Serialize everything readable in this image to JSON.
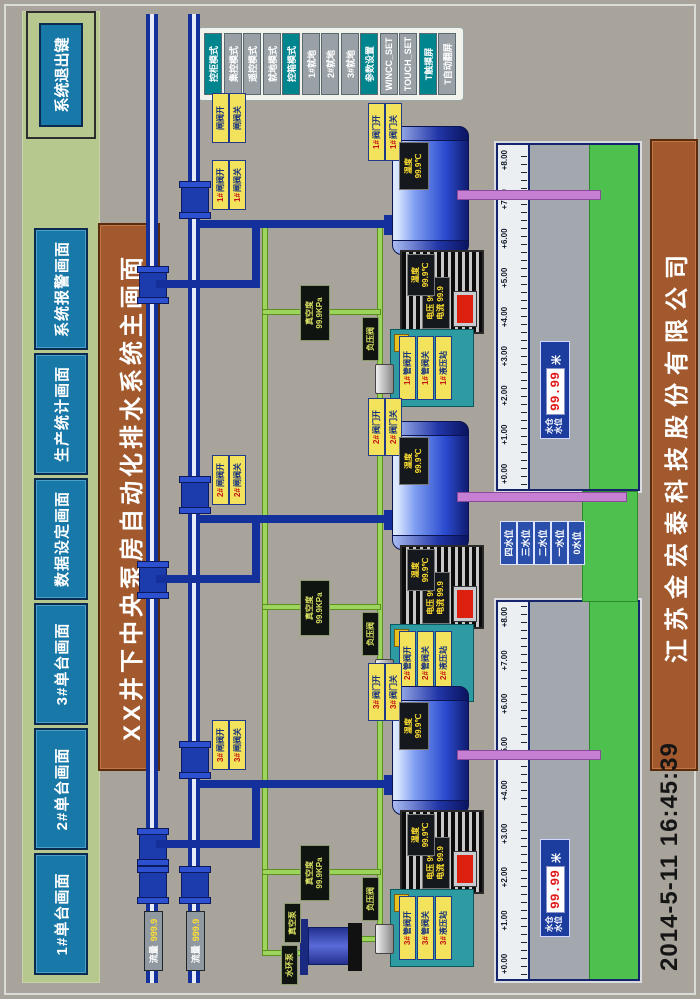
{
  "title": "XX井下中央泵房自动化排水系统主画面",
  "footer": {
    "company": "江苏金宏泰科技股份有限公司",
    "timestamp": "2014-5-11  16:45:39"
  },
  "header": {
    "nav_buttons": [
      {
        "label": "1#单台画面"
      },
      {
        "label": "2#单台画面"
      },
      {
        "label": "3#单台画面"
      },
      {
        "label": "数据设定画面"
      },
      {
        "label": "生产统计画面"
      },
      {
        "label": "系统报警画面"
      }
    ],
    "exit_button": "系统退出键"
  },
  "mode_panel": {
    "buttons": [
      {
        "label": "控柜模式",
        "style": "teal"
      },
      {
        "label": "集控模式",
        "style": "gray"
      },
      {
        "label": "遥控模式",
        "style": "gray"
      },
      {
        "label": "就地模式",
        "style": "gray"
      },
      {
        "label": "控箱模式",
        "style": "teal"
      },
      {
        "label": "1#就地",
        "style": "gray"
      },
      {
        "label": "2#就地",
        "style": "gray"
      },
      {
        "label": "3#就地",
        "style": "gray"
      },
      {
        "label": "参数设置",
        "style": "teal"
      },
      {
        "label": "WINCC_SET",
        "style": "gray"
      },
      {
        "label": "TOUCH_SET",
        "style": "gray"
      },
      {
        "label": "T触摸屏",
        "style": "teal"
      },
      {
        "label": "T自动翻屏",
        "style": "gray"
      }
    ]
  },
  "mains": [
    {
      "flow_label": "流量",
      "flow_value": "999.9"
    },
    {
      "flow_label": "流量",
      "flow_value": "999.9"
    }
  ],
  "right_valve_tags": [
    "闸阀开",
    "闸阀关"
  ],
  "pumps": [
    {
      "id": "1#",
      "gate_tags": [
        "闸阀开",
        "闸阀关"
      ],
      "suction_tags": [
        "阀门开",
        "阀门关"
      ],
      "hydraulic_tags": [
        "管阀开",
        "管阀关",
        "液压站"
      ],
      "vacuum_gauge": {
        "rows": [
          "真空度",
          "99.9KPa"
        ]
      },
      "vacuum_valve": "负压阀",
      "pump_plate": {
        "rows": [
          "温度",
          "99.9℃"
        ]
      },
      "motor_plate": {
        "rows": [
          "电压 99.9",
          "电流 99.9"
        ]
      },
      "motor_temp_plate": {
        "rows": [
          "温度",
          "99.9℃"
        ]
      }
    },
    {
      "id": "2#",
      "gate_tags": [
        "闸阀开",
        "闸阀关"
      ],
      "suction_tags": [
        "阀门开",
        "阀门关"
      ],
      "hydraulic_tags": [
        "管阀开",
        "管阀关",
        "液压站"
      ],
      "vacuum_gauge": {
        "rows": [
          "真空度",
          "99.9KPa"
        ]
      },
      "vacuum_valve": "负压阀",
      "pump_plate": {
        "rows": [
          "温度",
          "99.9℃"
        ]
      },
      "motor_plate": {
        "rows": [
          "电压 99.9",
          "电流 99.9"
        ]
      },
      "motor_temp_plate": {
        "rows": [
          "温度",
          "99.9℃"
        ]
      }
    },
    {
      "id": "3#",
      "gate_tags": [
        "闸阀开",
        "闸阀关"
      ],
      "suction_tags": [
        "阀门开",
        "阀门关"
      ],
      "hydraulic_tags": [
        "管阀开",
        "管阀关",
        "液压站"
      ],
      "vacuum_gauge": {
        "rows": [
          "真空度",
          "99.9KPa"
        ]
      },
      "vacuum_valve": "负压阀",
      "pump_plate": {
        "rows": [
          "温度",
          "99.9℃"
        ]
      },
      "motor_plate": {
        "rows": [
          "电压 99.9",
          "电流 99.9"
        ]
      },
      "motor_temp_plate": {
        "rows": [
          "温度",
          "99.9℃"
        ]
      }
    }
  ],
  "sumps": [
    {
      "scale": [
        "+0.00",
        "+1.00",
        "+2.00",
        "+3.00",
        "+4.00",
        "+5.00",
        "+6.00",
        "+7.00",
        "+8.00"
      ],
      "level_label_rows": [
        "水仓",
        "水位"
      ],
      "level_value": "99.99",
      "unit": "米"
    },
    {
      "scale": [
        "+0.00",
        "+1.00",
        "+2.00",
        "+3.00",
        "+4.00",
        "+5.00",
        "+6.00",
        "+7.00",
        "+8.00"
      ],
      "level_label_rows": [
        "水仓",
        "水位"
      ],
      "level_value": "99.99",
      "unit": "米"
    }
  ],
  "level_buttons": [
    "四水位",
    "三水位",
    "二水位",
    "一水位",
    "0水位"
  ],
  "vacuum_station": {
    "tags": [
      "水环泵",
      "真空泵"
    ]
  },
  "colors": {
    "accent_teal": "#00848e",
    "button_blue": "#1878a8",
    "band_green": "#b6c88e",
    "title_brown": "#a2592e",
    "pipe_blue": "#14309a",
    "vacuum_line_green": "#9cd45c",
    "suction_purple": "#c77fd4",
    "water_green": "#4ec04e",
    "alarm_red": "#dd2010",
    "led_red": "#e01818",
    "tag_yellow": "#f2e25c"
  }
}
